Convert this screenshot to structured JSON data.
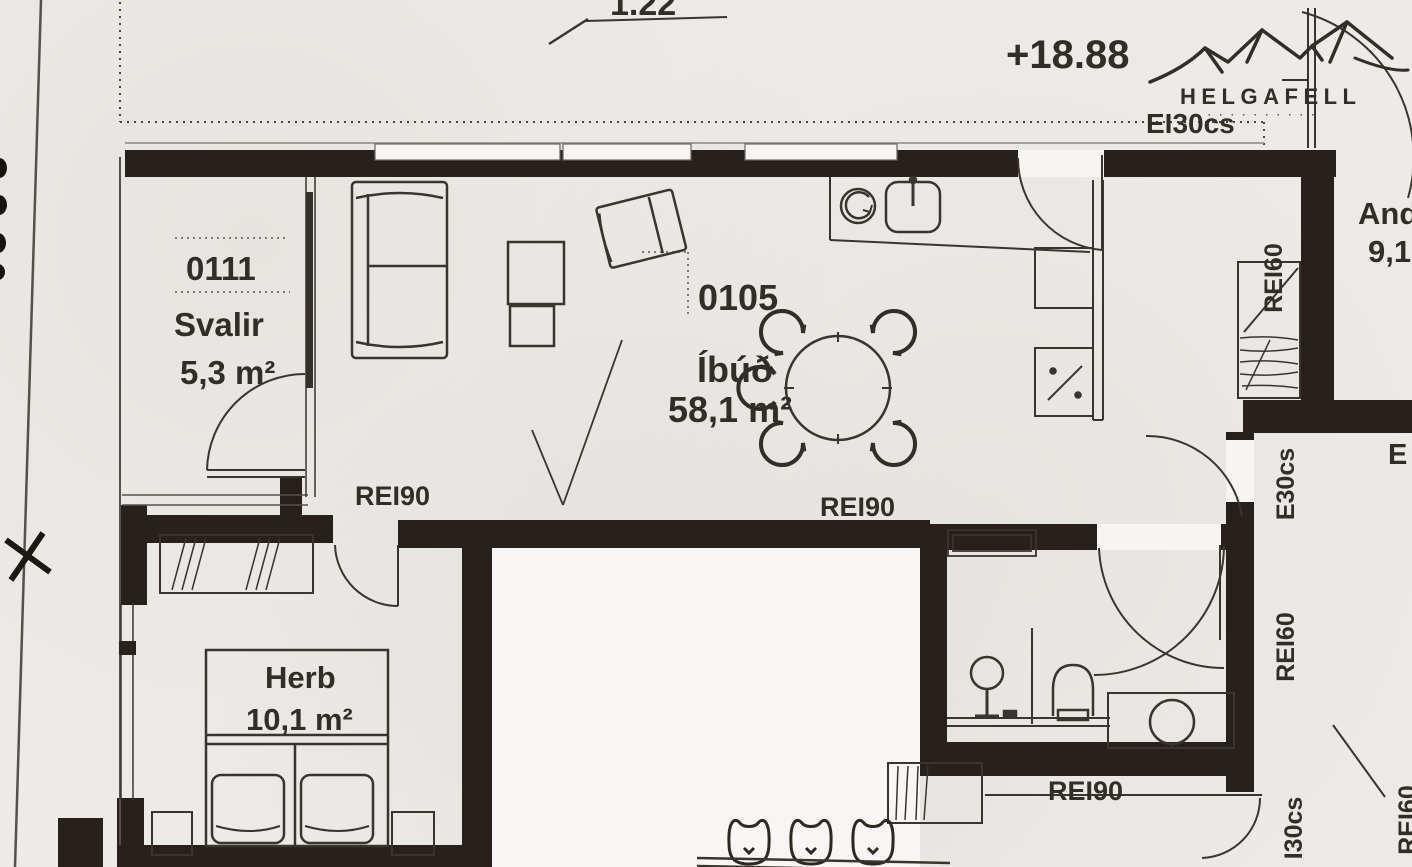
{
  "title": "Scanned apartment floor plan",
  "annotations": {
    "top_dimension": "1.22",
    "elevation": "+18.88"
  },
  "logo": {
    "name": "HELGAFELL",
    "subtext_illegible": "· · · · · · · · · ·"
  },
  "fire_ratings": {
    "top_wall": "EI30cs",
    "rei90_left": "REI90",
    "rei90_center": "REI90",
    "rei90_bottom": "REI90",
    "rei60_closet": "REI60",
    "e30cs_right": "E30cs",
    "rei60_right": "REI60",
    "i30cs_bottom": "I30cs",
    "rei60_corner_clipped": "REI60",
    "e_partial_clipped": "E"
  },
  "rooms": {
    "balcony": {
      "number": "0111",
      "name": "Svalir",
      "area": "5,3 m²"
    },
    "apartment": {
      "number": "0105",
      "name": "Íbúð",
      "area": "58,1 m²"
    },
    "bedroom": {
      "name": "Herb",
      "area": "10,1 m²"
    },
    "hall_clipped": {
      "name": "And",
      "area": "9,1"
    }
  },
  "colors": {
    "paper": "#edebe7",
    "wall": "#28211b",
    "ink": "#332d27"
  }
}
